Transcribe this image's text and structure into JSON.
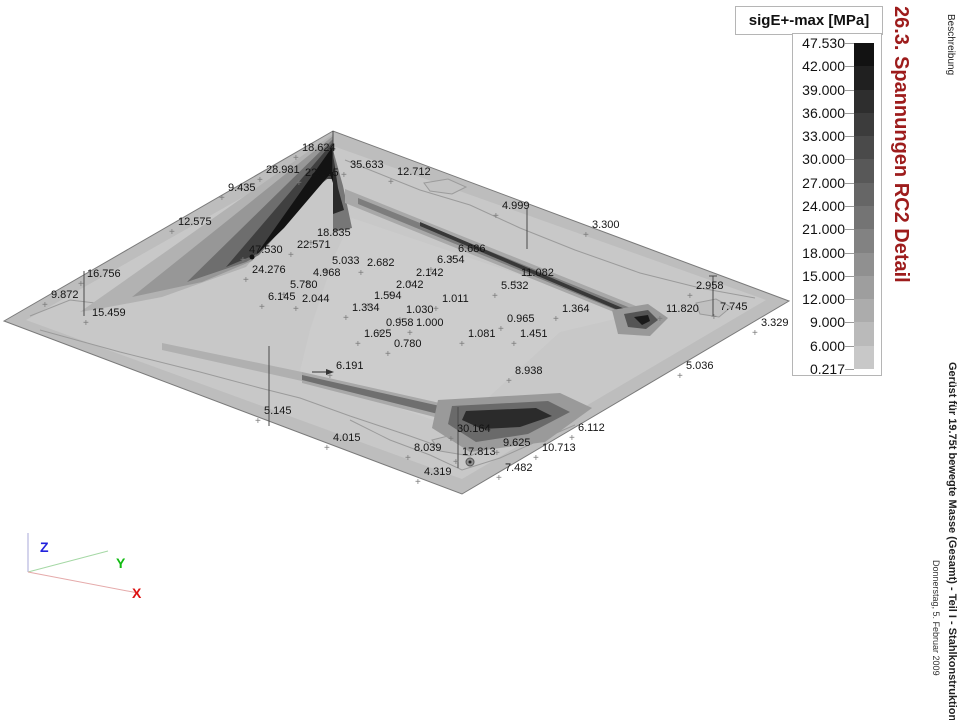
{
  "legend": {
    "title": "sigE+-max [MPa]",
    "levels": [
      "47.530",
      "42.000",
      "39.000",
      "36.000",
      "33.000",
      "30.000",
      "27.000",
      "24.000",
      "21.000",
      "18.000",
      "15.000",
      "12.000",
      "9.000",
      "6.000",
      "0.217"
    ],
    "band_colors": [
      "#121212",
      "#202020",
      "#2e2e2e",
      "#3c3c3c",
      "#4a4a4a",
      "#585858",
      "#666666",
      "#747474",
      "#828282",
      "#909090",
      "#9e9e9e",
      "#acacac",
      "#bababa",
      "#c8c8c8"
    ]
  },
  "margin_texts": {
    "section_title": "26.3. Spannungen RC2 Detail",
    "section_title_color": "#9d1c1c",
    "column_header": "Beschreibung",
    "project_title": "Gerüst für 19.75t bewegte Masse (Gesamt) - Teil I - Stahlkonstruktion",
    "date": "Donnerstag, 5. Februar 2009"
  },
  "axes": {
    "x": "X",
    "y": "Y",
    "z": "Z",
    "x_color": "#dd1111",
    "y_color": "#11bb11",
    "z_color": "#2222dd"
  },
  "chart_data": {
    "type": "heatmap",
    "subtype": "3d-isometric-stress-contour",
    "title": "sigE+-max [MPa]",
    "units": "MPa",
    "min": 0.217,
    "max": 47.53,
    "levels": [
      0.217,
      6,
      9,
      12,
      15,
      18,
      21,
      24,
      27,
      30,
      33,
      36,
      39,
      42,
      47.53
    ],
    "points": [
      {
        "v": "18.624",
        "x": 302,
        "y": 142
      },
      {
        "v": "28.981",
        "x": 266,
        "y": 164
      },
      {
        "v": "22.195",
        "x": 305,
        "y": 167
      },
      {
        "v": "35.633",
        "x": 350,
        "y": 159
      },
      {
        "v": "12.712",
        "x": 397,
        "y": 166
      },
      {
        "v": "9.435",
        "x": 228,
        "y": 182
      },
      {
        "v": "12.575",
        "x": 178,
        "y": 216
      },
      {
        "v": "16.756",
        "x": 87,
        "y": 268
      },
      {
        "v": "9.872",
        "x": 51,
        "y": 289
      },
      {
        "v": "15.459",
        "x": 92,
        "y": 307
      },
      {
        "v": "18.835",
        "x": 317,
        "y": 227
      },
      {
        "v": "22.571",
        "x": 297,
        "y": 239
      },
      {
        "v": "47.530",
        "x": 249,
        "y": 244
      },
      {
        "v": "24.276",
        "x": 252,
        "y": 264
      },
      {
        "v": "5.033",
        "x": 332,
        "y": 255
      },
      {
        "v": "2.682",
        "x": 367,
        "y": 257
      },
      {
        "v": "4.968",
        "x": 313,
        "y": 267
      },
      {
        "v": "5.780",
        "x": 290,
        "y": 279
      },
      {
        "v": "6.145",
        "x": 268,
        "y": 291
      },
      {
        "v": "2.044",
        "x": 302,
        "y": 293
      },
      {
        "v": "6.686",
        "x": 458,
        "y": 243
      },
      {
        "v": "6.354",
        "x": 437,
        "y": 254
      },
      {
        "v": "2.142",
        "x": 416,
        "y": 267
      },
      {
        "v": "2.042",
        "x": 396,
        "y": 279
      },
      {
        "v": "1.594",
        "x": 374,
        "y": 290
      },
      {
        "v": "1.334",
        "x": 352,
        "y": 302
      },
      {
        "v": "1.030",
        "x": 406,
        "y": 304
      },
      {
        "v": "1.011",
        "x": 442,
        "y": 293
      },
      {
        "v": "0.958",
        "x": 386,
        "y": 317
      },
      {
        "v": "1.000",
        "x": 416,
        "y": 317
      },
      {
        "v": "1.625",
        "x": 364,
        "y": 328
      },
      {
        "v": "0.780",
        "x": 394,
        "y": 338
      },
      {
        "v": "11.082",
        "x": 521,
        "y": 267
      },
      {
        "v": "5.532",
        "x": 501,
        "y": 280
      },
      {
        "v": "0.965",
        "x": 507,
        "y": 313
      },
      {
        "v": "1.081",
        "x": 468,
        "y": 328
      },
      {
        "v": "1.451",
        "x": 520,
        "y": 328
      },
      {
        "v": "1.364",
        "x": 562,
        "y": 303
      },
      {
        "v": "4.999",
        "x": 502,
        "y": 200
      },
      {
        "v": "3.300",
        "x": 592,
        "y": 219
      },
      {
        "v": "2.958",
        "x": 696,
        "y": 280
      },
      {
        "v": "7.745",
        "x": 720,
        "y": 301
      },
      {
        "v": "11.820",
        "x": 666,
        "y": 303
      },
      {
        "v": "3.329",
        "x": 761,
        "y": 317
      },
      {
        "v": "5.036",
        "x": 686,
        "y": 360
      },
      {
        "v": "6.191",
        "x": 336,
        "y": 360
      },
      {
        "v": "8.938",
        "x": 515,
        "y": 365
      },
      {
        "v": "5.145",
        "x": 264,
        "y": 405
      },
      {
        "v": "4.015",
        "x": 333,
        "y": 432
      },
      {
        "v": "8.039",
        "x": 414,
        "y": 442
      },
      {
        "v": "30.164",
        "x": 457,
        "y": 423
      },
      {
        "v": "17.813",
        "x": 462,
        "y": 446
      },
      {
        "v": "9.625",
        "x": 503,
        "y": 437
      },
      {
        "v": "10.713",
        "x": 542,
        "y": 442
      },
      {
        "v": "4.319",
        "x": 424,
        "y": 466
      },
      {
        "v": "7.482",
        "x": 505,
        "y": 462
      },
      {
        "v": "6.112",
        "x": 578,
        "y": 422
      }
    ]
  }
}
